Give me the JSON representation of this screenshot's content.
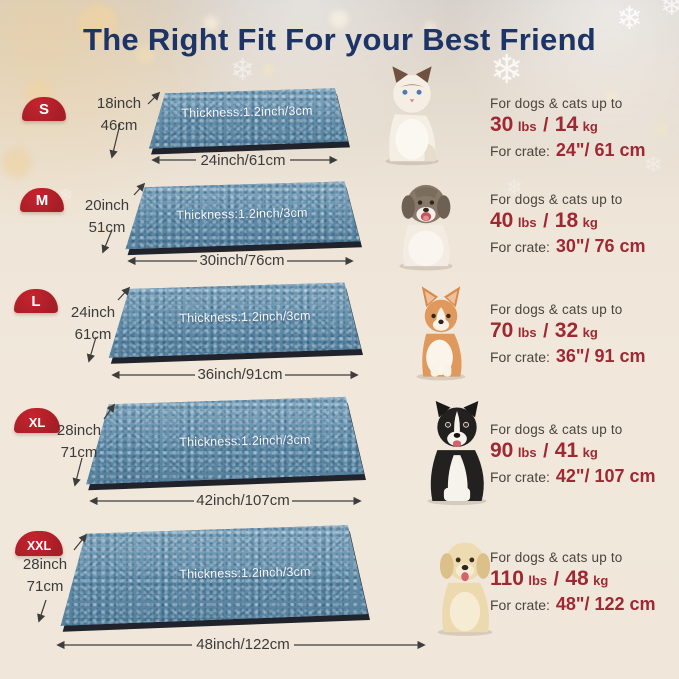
{
  "title": "The Right Fit For your Best Friend",
  "colors": {
    "title_navy": "#1d3466",
    "badge_red": "#a81e26",
    "accent_red": "#9f2832",
    "mat_blue": "#6290ad",
    "background_cream": "#f0e7da"
  },
  "decor": {
    "snowflake": "❄"
  },
  "rows": [
    {
      "size": "S",
      "pet": "ragdoll-cat",
      "depth_in": "18inch",
      "depth_cm": "46cm",
      "thickness": "Thickness:1.2inch/3cm",
      "width_label": "24inch/61cm",
      "fit_line": "For dogs & cats up to",
      "weight": {
        "lbs": "30",
        "lbs_unit": "lbs",
        "sep": "/",
        "kg": "14",
        "kg_unit": "kg"
      },
      "crate_label": "For crate:",
      "crate_value": "24\"/ 61 cm"
    },
    {
      "size": "M",
      "pet": "puppy",
      "depth_in": "20inch",
      "depth_cm": "51cm",
      "thickness": "Thickness:1.2inch/3cm",
      "width_label": "30inch/76cm",
      "fit_line": "For dogs & cats up to",
      "weight": {
        "lbs": "40",
        "lbs_unit": "lbs",
        "sep": "/",
        "kg": "18",
        "kg_unit": "kg"
      },
      "crate_label": "For crate:",
      "crate_value": "30\"/ 76 cm"
    },
    {
      "size": "L",
      "pet": "corgi",
      "depth_in": "24inch",
      "depth_cm": "61cm",
      "thickness": "Thickness:1.2inch/3cm",
      "width_label": "36inch/91cm",
      "fit_line": "For dogs & cats up to",
      "weight": {
        "lbs": "70",
        "lbs_unit": "lbs",
        "sep": "/",
        "kg": "32",
        "kg_unit": "kg"
      },
      "crate_label": "For crate:",
      "crate_value": "36\"/ 91 cm"
    },
    {
      "size": "XL",
      "pet": "border-collie",
      "depth_in": "28inch",
      "depth_cm": "71cm",
      "thickness": "Thickness:1.2inch/3cm",
      "width_label": "42inch/107cm",
      "fit_line": "For dogs & cats up to",
      "weight": {
        "lbs": "90",
        "lbs_unit": "lbs",
        "sep": "/",
        "kg": "41",
        "kg_unit": "kg"
      },
      "crate_label": "For crate:",
      "crate_value": "42\"/ 107 cm"
    },
    {
      "size": "XXL",
      "pet": "golden-retriever",
      "depth_in": "28inch",
      "depth_cm": "71cm",
      "thickness": "Thickness:1.2inch/3cm",
      "width_label": "48inch/122cm",
      "fit_line": "For dogs & cats up to",
      "weight": {
        "lbs": "110",
        "lbs_unit": "lbs",
        "sep": "/",
        "kg": "48",
        "kg_unit": "kg"
      },
      "crate_label": "For crate:",
      "crate_value": "48\"/ 122 cm"
    }
  ]
}
